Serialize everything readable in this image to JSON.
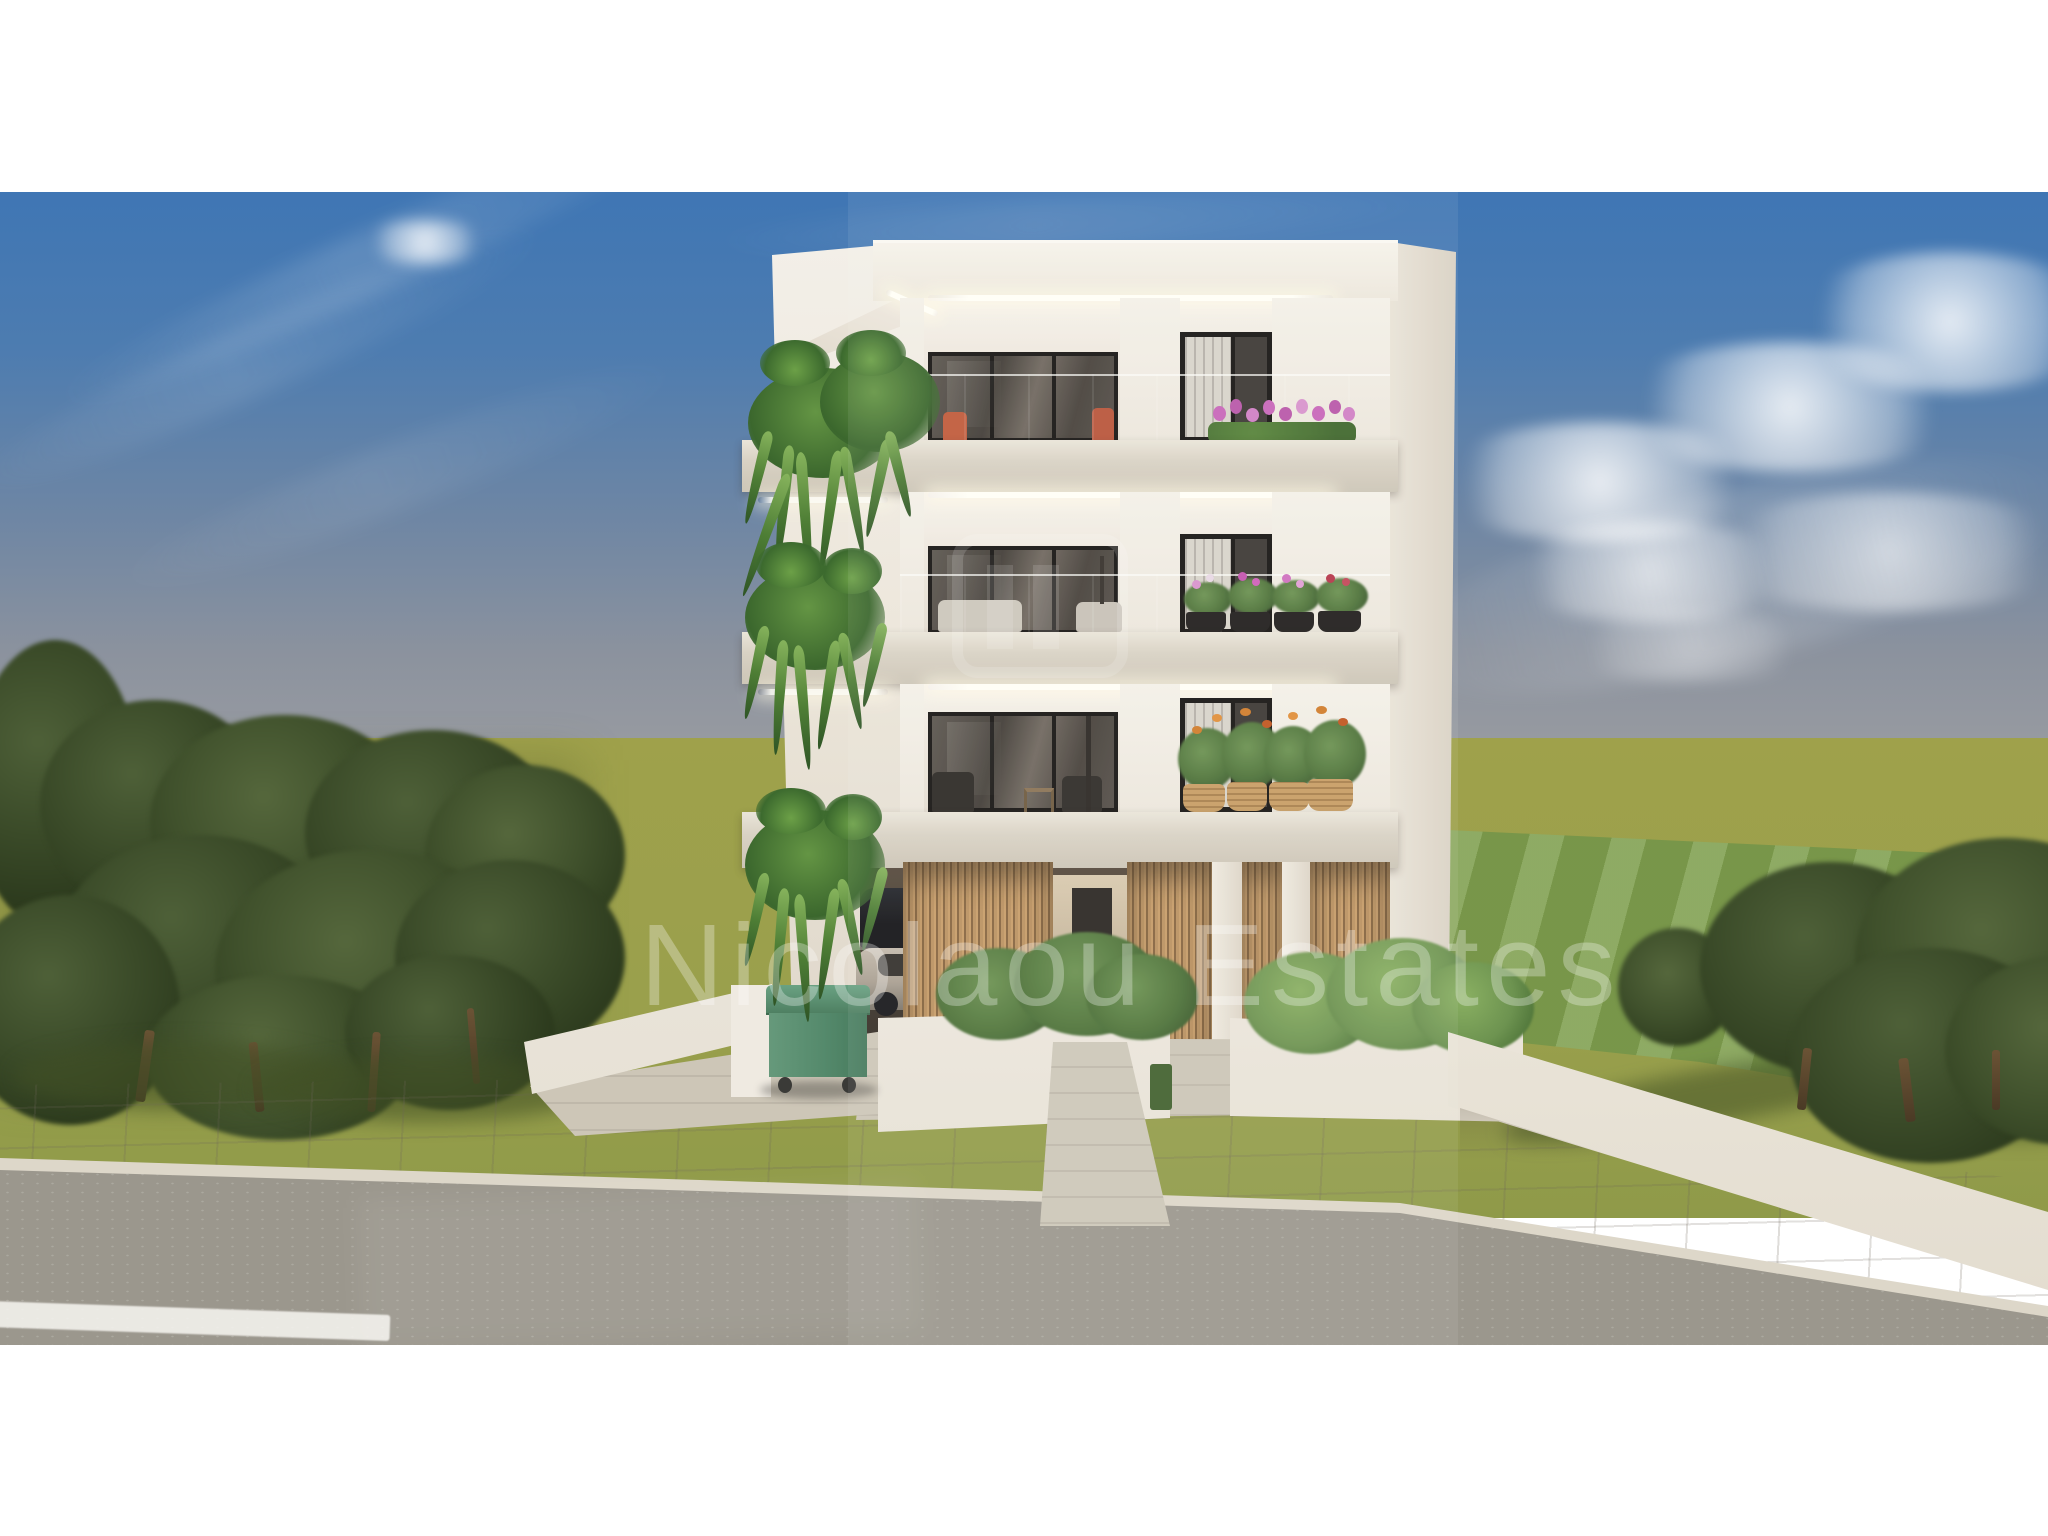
{
  "scene": {
    "title": "3D exterior rendering of a modern three-storey apartment building",
    "watermark_text": "Nicolaou Estates",
    "environment": {
      "sky": "blue sky with soft streaked clouds",
      "field": "olive-green open field to the horizon",
      "trees": "olive tree clusters on left and right",
      "lawn": "bright mowed lawn strip behind right boundary wall",
      "sidewalk": "beige tiled pavement",
      "road": "grey asphalt road with white road marking"
    },
    "building": {
      "storeys": 3,
      "features": {
        "led_strips": "warm LED strip lighting under roof and balcony slabs",
        "balustrades": "frameless glass balcony balustrades",
        "glazing": "dark-framed sliding glass doors and windows with vertical blinds",
        "ground_level": "covered carport with vertical timber slat screens",
        "entrance": "central tiled entrance walkway",
        "planters": "white planter walls with green shrubs",
        "hanging_plants": "cascading ferns on the left edge of each balcony",
        "flowers_top_balcony": "pink tulips",
        "flowers_middle_balcony": "black pots with pink, magenta and red flowers",
        "flowers_ground_balcony": "orange bird-of-paradise in wicker baskets"
      }
    },
    "objects": {
      "waste_bin": "green wheelie waste container",
      "vehicles": "cars parked under the carport",
      "boundary_walls": "low white garden walls on both sides"
    },
    "palette": {
      "sky_top": "#3f76b4",
      "sky_horizon": "#989ba1",
      "field_green": "#9fa14b",
      "lawn_green": "#7f9f4e",
      "tree_green": "#3a4a28",
      "facade_white": "#f2eee6",
      "slab_beige": "#d8d1c3",
      "glass_dark": "#46403a",
      "timber": "#b08a57",
      "fern_green": "#5d8f3e",
      "flower_pink": "#c76ab8",
      "flower_orange": "#d07c2a",
      "bin_green": "#5c8f72",
      "road_grey": "#9b978d",
      "pavement_beige": "#c9c3b5"
    }
  }
}
